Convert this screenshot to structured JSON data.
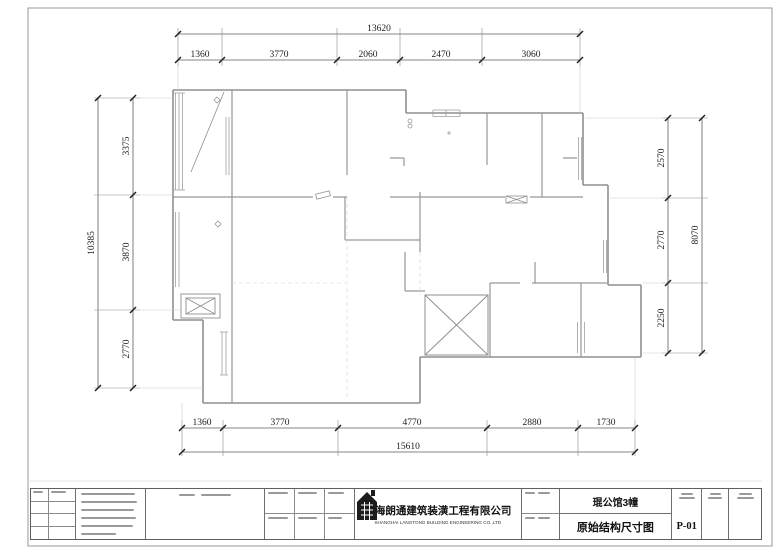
{
  "dimensions": {
    "top": {
      "total": "13620",
      "segments": [
        "1360",
        "3770",
        "2060",
        "2470",
        "3060"
      ]
    },
    "bottom": {
      "total": "15610",
      "segments": [
        "1360",
        "3770",
        "4770",
        "2880",
        "1730"
      ]
    },
    "left": {
      "total": "10385",
      "segments": [
        "3375",
        "3870",
        "2770"
      ]
    },
    "right": {
      "total": "8070",
      "segments": [
        "2570",
        "2770",
        "2250"
      ]
    }
  },
  "title_block": {
    "company_cn": "上海朗通建筑装潢工程有限公司",
    "company_en": "SHANGHAI LANGTONG BUILDING ENGINEERING CO.,LTD",
    "project_name": "琨公馆3幢",
    "drawing_title": "原始结构尺寸图",
    "drawing_no": "P-01"
  },
  "plan": {
    "symbols": [
      "flue-shaft",
      "elevator-shaft",
      "balcony-door-swing",
      "window-hatch",
      "double-door"
    ]
  }
}
